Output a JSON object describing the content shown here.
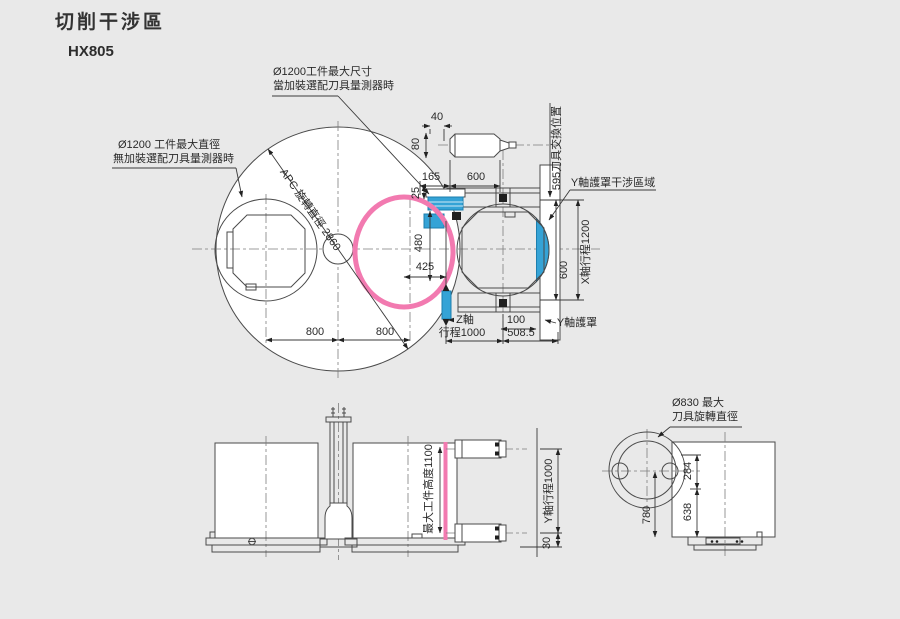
{
  "title": "切削干涉區",
  "model": "HX805",
  "colors": {
    "background": "#e9e9e9",
    "line": "#4a4a4a",
    "pink": "#f27ab0",
    "blue": "#35a3d6"
  },
  "top_view": {
    "label_max_size_1": "Ø1200工件最大尺寸",
    "label_max_size_2": "當加裝選配刀具量測器時",
    "label_max_dia_1": "Ø1200 工件最大直徑",
    "label_max_dia_2": "無加裝選配刀具量測器時",
    "apc": "APC 旋轉直徑 2860",
    "tool_change": "595刀具交換位置",
    "y_cover_zone": "Y軸護罩干涉區域",
    "y_cover": "Y軸護罩",
    "x_travel": "X軸行程1200",
    "z_axis": "Z軸",
    "z_travel": "行程1000",
    "d40": "40",
    "d80": "80",
    "d165": "165",
    "d600_top": "600",
    "d25": "25",
    "d480": "480",
    "d425": "425",
    "d800_l": "800",
    "d800_r": "800",
    "d600_r": "600",
    "d100": "100",
    "d508": "508.5"
  },
  "front_view": {
    "max_height": "最大工件高度1100"
  },
  "side_view": {
    "y_travel": "Y軸行程1000",
    "d30": "30"
  },
  "tool_view": {
    "label_1": "Ø830 最大",
    "label_2": "刀具旋轉直徑",
    "d284": "284",
    "d638": "638",
    "d780": "780"
  }
}
